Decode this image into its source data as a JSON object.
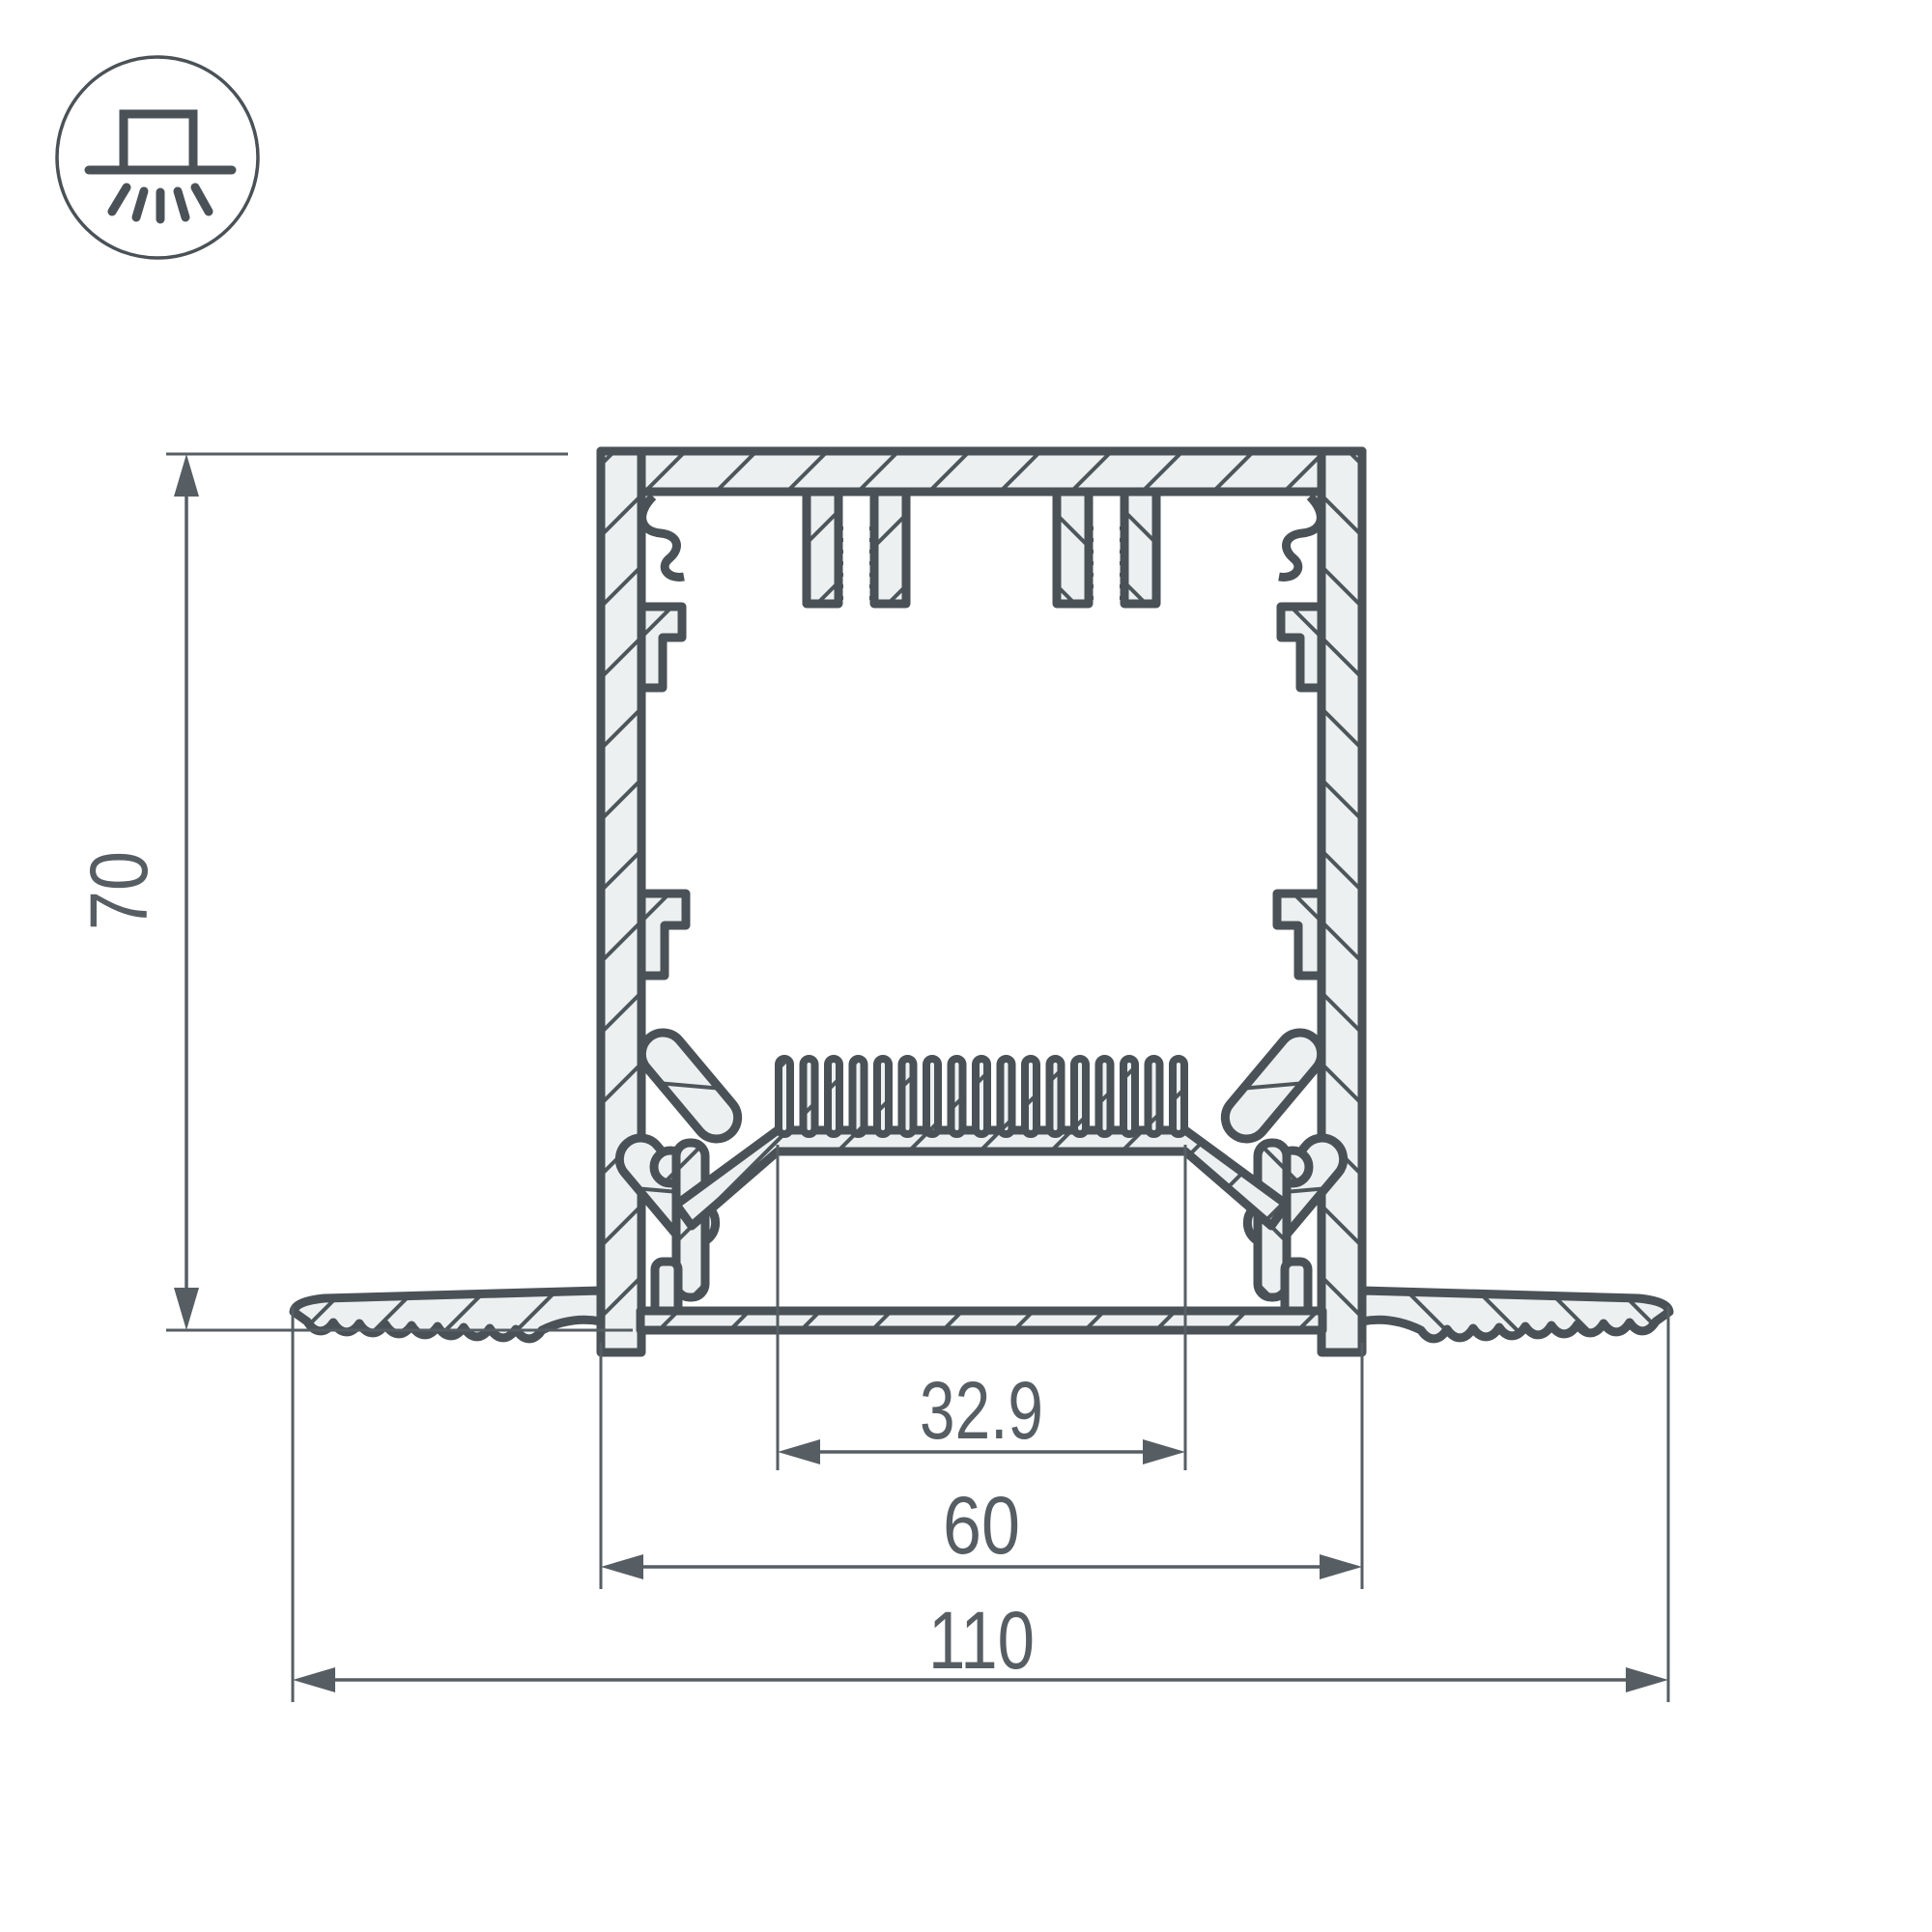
{
  "icon": {
    "name": "recessed-light-icon"
  },
  "drawing": {
    "title": "recessed-led-profile-cross-section",
    "dimensions": {
      "height": {
        "label": "70"
      },
      "inner_width": {
        "label": "32.9"
      },
      "body_width": {
        "label": "60"
      },
      "overall_width": {
        "label": "110"
      }
    },
    "colors": {
      "line": "#4a5257",
      "dim": "#565e63",
      "fill": "#edf0f1",
      "background": "#ffffff"
    }
  }
}
